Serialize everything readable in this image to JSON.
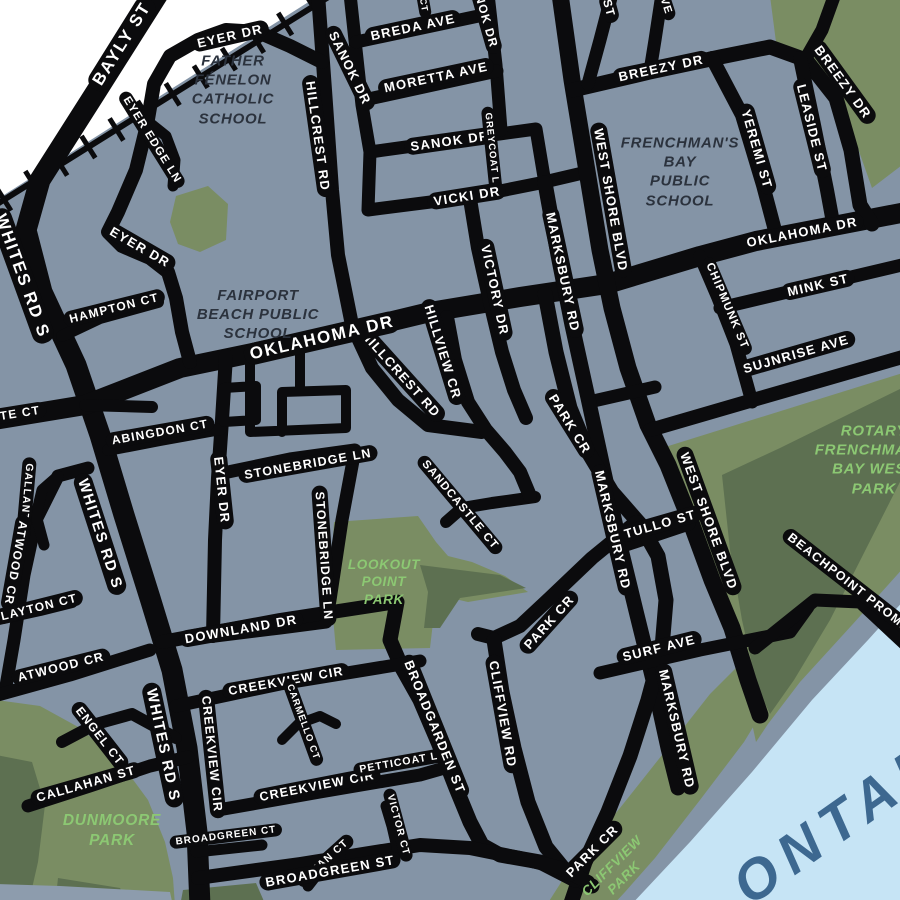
{
  "map": {
    "colors": {
      "background": "#8494a6",
      "road": "#0b0b0d",
      "road_label": "#ffffff",
      "park": "#7a8d63",
      "park_dark": "#5d7051",
      "park_label": "#8cc873",
      "school_label": "#2b323d",
      "water": "#c6e4f5",
      "water_label": "#3d6890",
      "offmap": "#ffffff",
      "shore_band": "#8d9cad",
      "railway": "#0b0b0d"
    },
    "street_labels": [
      {
        "t": "BAYLY ST",
        "x": 122,
        "y": 44,
        "r": -58,
        "s": 17
      },
      {
        "t": "WHITES RD S",
        "x": 22,
        "y": 276,
        "r": 70,
        "s": 17
      },
      {
        "t": "WHITES RD S",
        "x": 100,
        "y": 534,
        "r": 72,
        "s": 15
      },
      {
        "t": "WHITES RD S",
        "x": 163,
        "y": 745,
        "r": 78,
        "s": 15
      },
      {
        "t": "EYER DR",
        "x": 230,
        "y": 36,
        "r": -13,
        "s": 13
      },
      {
        "t": "EYER EDGE LN",
        "x": 152,
        "y": 140,
        "r": 58,
        "s": 11.5
      },
      {
        "t": "EYER DR",
        "x": 140,
        "y": 247,
        "r": 30,
        "s": 13
      },
      {
        "t": "EYER DR",
        "x": 222,
        "y": 490,
        "r": 84,
        "s": 13
      },
      {
        "t": "HAMPTON CT",
        "x": 114,
        "y": 308,
        "r": -14,
        "s": 12
      },
      {
        "t": "BREDA AVE",
        "x": 413,
        "y": 27,
        "r": -12,
        "s": 13
      },
      {
        "t": "SANOK DR",
        "x": 350,
        "y": 68,
        "r": 64,
        "s": 13
      },
      {
        "t": "MORETTA AVE",
        "x": 436,
        "y": 77,
        "r": -12,
        "s": 13
      },
      {
        "t": "SANOK DR",
        "x": 484,
        "y": 12,
        "r": 74,
        "s": 12
      },
      {
        "t": "SANOK DR",
        "x": 450,
        "y": 141,
        "r": -8,
        "s": 13
      },
      {
        "t": "GREYCOAT LN",
        "x": 492,
        "y": 152,
        "r": 84,
        "s": 9.5
      },
      {
        "t": "VICKI DR",
        "x": 467,
        "y": 196,
        "r": -9,
        "s": 13
      },
      {
        "t": "HILLCREST RD",
        "x": 318,
        "y": 136,
        "r": 82,
        "s": 13
      },
      {
        "t": "HILLCREST RD",
        "x": 401,
        "y": 374,
        "r": 48,
        "s": 13
      },
      {
        "t": "HILLVIEW CR",
        "x": 443,
        "y": 352,
        "r": 73,
        "s": 13
      },
      {
        "t": "VICTORY DR",
        "x": 495,
        "y": 290,
        "r": 78,
        "s": 13
      },
      {
        "t": "MARKSBURY RD",
        "x": 563,
        "y": 272,
        "r": 78,
        "s": 13
      },
      {
        "t": "MARKSBURY RD",
        "x": 613,
        "y": 530,
        "r": 77,
        "s": 13
      },
      {
        "t": "MARKSBURY RD",
        "x": 677,
        "y": 729,
        "r": 77,
        "s": 13
      },
      {
        "t": "WEST SHORE BLVD",
        "x": 611,
        "y": 200,
        "r": 80,
        "s": 13
      },
      {
        "t": "WEST SHORE BLVD",
        "x": 709,
        "y": 521,
        "r": 70,
        "s": 13
      },
      {
        "t": "BREEZY DR",
        "x": 661,
        "y": 68,
        "r": -12,
        "s": 13
      },
      {
        "t": "BREEZY DR",
        "x": 843,
        "y": 82,
        "r": 54,
        "s": 13
      },
      {
        "t": "YEREMI ST",
        "x": 757,
        "y": 149,
        "r": 74,
        "s": 13
      },
      {
        "t": "LEASIDE ST",
        "x": 812,
        "y": 128,
        "r": 76,
        "s": 13
      },
      {
        "t": "OKLAHOMA DR",
        "x": 322,
        "y": 338,
        "r": -13,
        "s": 17
      },
      {
        "t": "OKLAHOMA DR",
        "x": 802,
        "y": 232,
        "r": -11,
        "s": 13
      },
      {
        "t": "MINK ST",
        "x": 818,
        "y": 285,
        "r": -13,
        "s": 13
      },
      {
        "t": "CHIPMUNK ST",
        "x": 727,
        "y": 306,
        "r": 67,
        "s": 11.5
      },
      {
        "t": "SUJNRISE AVE",
        "x": 796,
        "y": 354,
        "r": -16,
        "s": 13
      },
      {
        "t": "TULLO ST",
        "x": 660,
        "y": 524,
        "r": -16,
        "s": 13
      },
      {
        "t": "PARK CR",
        "x": 570,
        "y": 424,
        "r": 58,
        "s": 13
      },
      {
        "t": "PARK CR",
        "x": 549,
        "y": 622,
        "r": -48,
        "s": 13
      },
      {
        "t": "PARK CR",
        "x": 592,
        "y": 851,
        "r": -45,
        "s": 13
      },
      {
        "t": "SURF AVE",
        "x": 659,
        "y": 648,
        "r": -14,
        "s": 13
      },
      {
        "t": "BEACHPOINT PROMENADE",
        "x": 865,
        "y": 595,
        "r": 38,
        "s": 12.5
      },
      {
        "t": "STONEBRIDGE LN",
        "x": 308,
        "y": 464,
        "r": -10,
        "s": 12.5
      },
      {
        "t": "STONEBRIDGE LN",
        "x": 324,
        "y": 556,
        "r": 86,
        "s": 12.5
      },
      {
        "t": "SANDCASTLE CT",
        "x": 460,
        "y": 505,
        "r": 50,
        "s": 11.5
      },
      {
        "t": "ABINGDON CT",
        "x": 160,
        "y": 432,
        "r": -10,
        "s": 12
      },
      {
        "t": "TE CT",
        "x": 20,
        "y": 413,
        "r": -9,
        "s": 12
      },
      {
        "t": "GALLANT CT",
        "x": 26,
        "y": 502,
        "r": 95,
        "s": 10.5
      },
      {
        "t": "ATWOOD CR",
        "x": 16,
        "y": 563,
        "r": 100,
        "s": 12
      },
      {
        "t": "LAYTON CT",
        "x": 39,
        "y": 607,
        "r": -14,
        "s": 12
      },
      {
        "t": "ATWOOD CR",
        "x": 61,
        "y": 667,
        "r": -14,
        "s": 12.5
      },
      {
        "t": "DOWNLAND DR",
        "x": 241,
        "y": 629,
        "r": -10,
        "s": 13
      },
      {
        "t": "CREEKVIEW CIR",
        "x": 286,
        "y": 681,
        "r": -10,
        "s": 12.5
      },
      {
        "t": "CREEKVIEW CIR",
        "x": 212,
        "y": 754,
        "r": 84,
        "s": 12.5
      },
      {
        "t": "CREEKVIEW CIR",
        "x": 317,
        "y": 786,
        "r": -11,
        "s": 12.5
      },
      {
        "t": "CARMELLO CT",
        "x": 303,
        "y": 722,
        "r": 70,
        "s": 9.5
      },
      {
        "t": "PETTICOAT LN",
        "x": 403,
        "y": 762,
        "r": -10,
        "s": 10.5
      },
      {
        "t": "BROADGARDEN ST",
        "x": 435,
        "y": 727,
        "r": 68,
        "s": 13
      },
      {
        "t": "CLIFFVIEW RD",
        "x": 503,
        "y": 714,
        "r": 80,
        "s": 13
      },
      {
        "t": "ENGEL CT",
        "x": 100,
        "y": 736,
        "r": 52,
        "s": 12
      },
      {
        "t": "CALLAHAN ST",
        "x": 86,
        "y": 784,
        "r": -16,
        "s": 12.5
      },
      {
        "t": "BROADGREEN CT",
        "x": 226,
        "y": 836,
        "r": -7,
        "s": 10
      },
      {
        "t": "BRIAN CT",
        "x": 325,
        "y": 861,
        "r": -42,
        "s": 10.5
      },
      {
        "t": "VICTOR CT",
        "x": 398,
        "y": 825,
        "r": 75,
        "s": 10
      },
      {
        "t": "BROADGREEN ST",
        "x": 330,
        "y": 871,
        "r": -10,
        "s": 13
      },
      {
        "t": "ST",
        "x": 609,
        "y": 8,
        "r": 75,
        "s": 12
      },
      {
        "t": "VE",
        "x": 666,
        "y": 6,
        "r": 72,
        "s": 11
      },
      {
        "t": "CT",
        "x": 424,
        "y": 5,
        "r": 80,
        "s": 9
      }
    ],
    "area_labels": [
      {
        "t": "FATHER\nFÉNELON\nCATHOLIC\nSCHOOL",
        "x": 233,
        "y": 90,
        "s": 15,
        "c": "school"
      },
      {
        "t": "FAIRPORT\nBEACH PUBLIC\nSCHOOL",
        "x": 258,
        "y": 315,
        "s": 15,
        "c": "school"
      },
      {
        "t": "FRENCHMAN'S\nBAY\nPUBLIC\nSCHOOL",
        "x": 680,
        "y": 172,
        "s": 15,
        "c": "school"
      },
      {
        "t": "LOOKOUT\nPOINT\nPARK",
        "x": 384,
        "y": 582,
        "s": 13.5,
        "c": "park"
      },
      {
        "t": "DUNMOORE\nPARK",
        "x": 112,
        "y": 831,
        "s": 15.5,
        "c": "park"
      },
      {
        "t": "ROTARY\nFRENCHMAN'S\nBAY WEST\nPARK",
        "x": 874,
        "y": 460,
        "s": 15,
        "c": "park"
      },
      {
        "t": "CLIFFVIEW\nPARK",
        "x": 618,
        "y": 872,
        "s": 13.5,
        "c": "park",
        "r": -45
      },
      {
        "t": "ONTARIO",
        "x": 872,
        "y": 798,
        "s": 56,
        "c": "water",
        "r": -35
      }
    ]
  }
}
